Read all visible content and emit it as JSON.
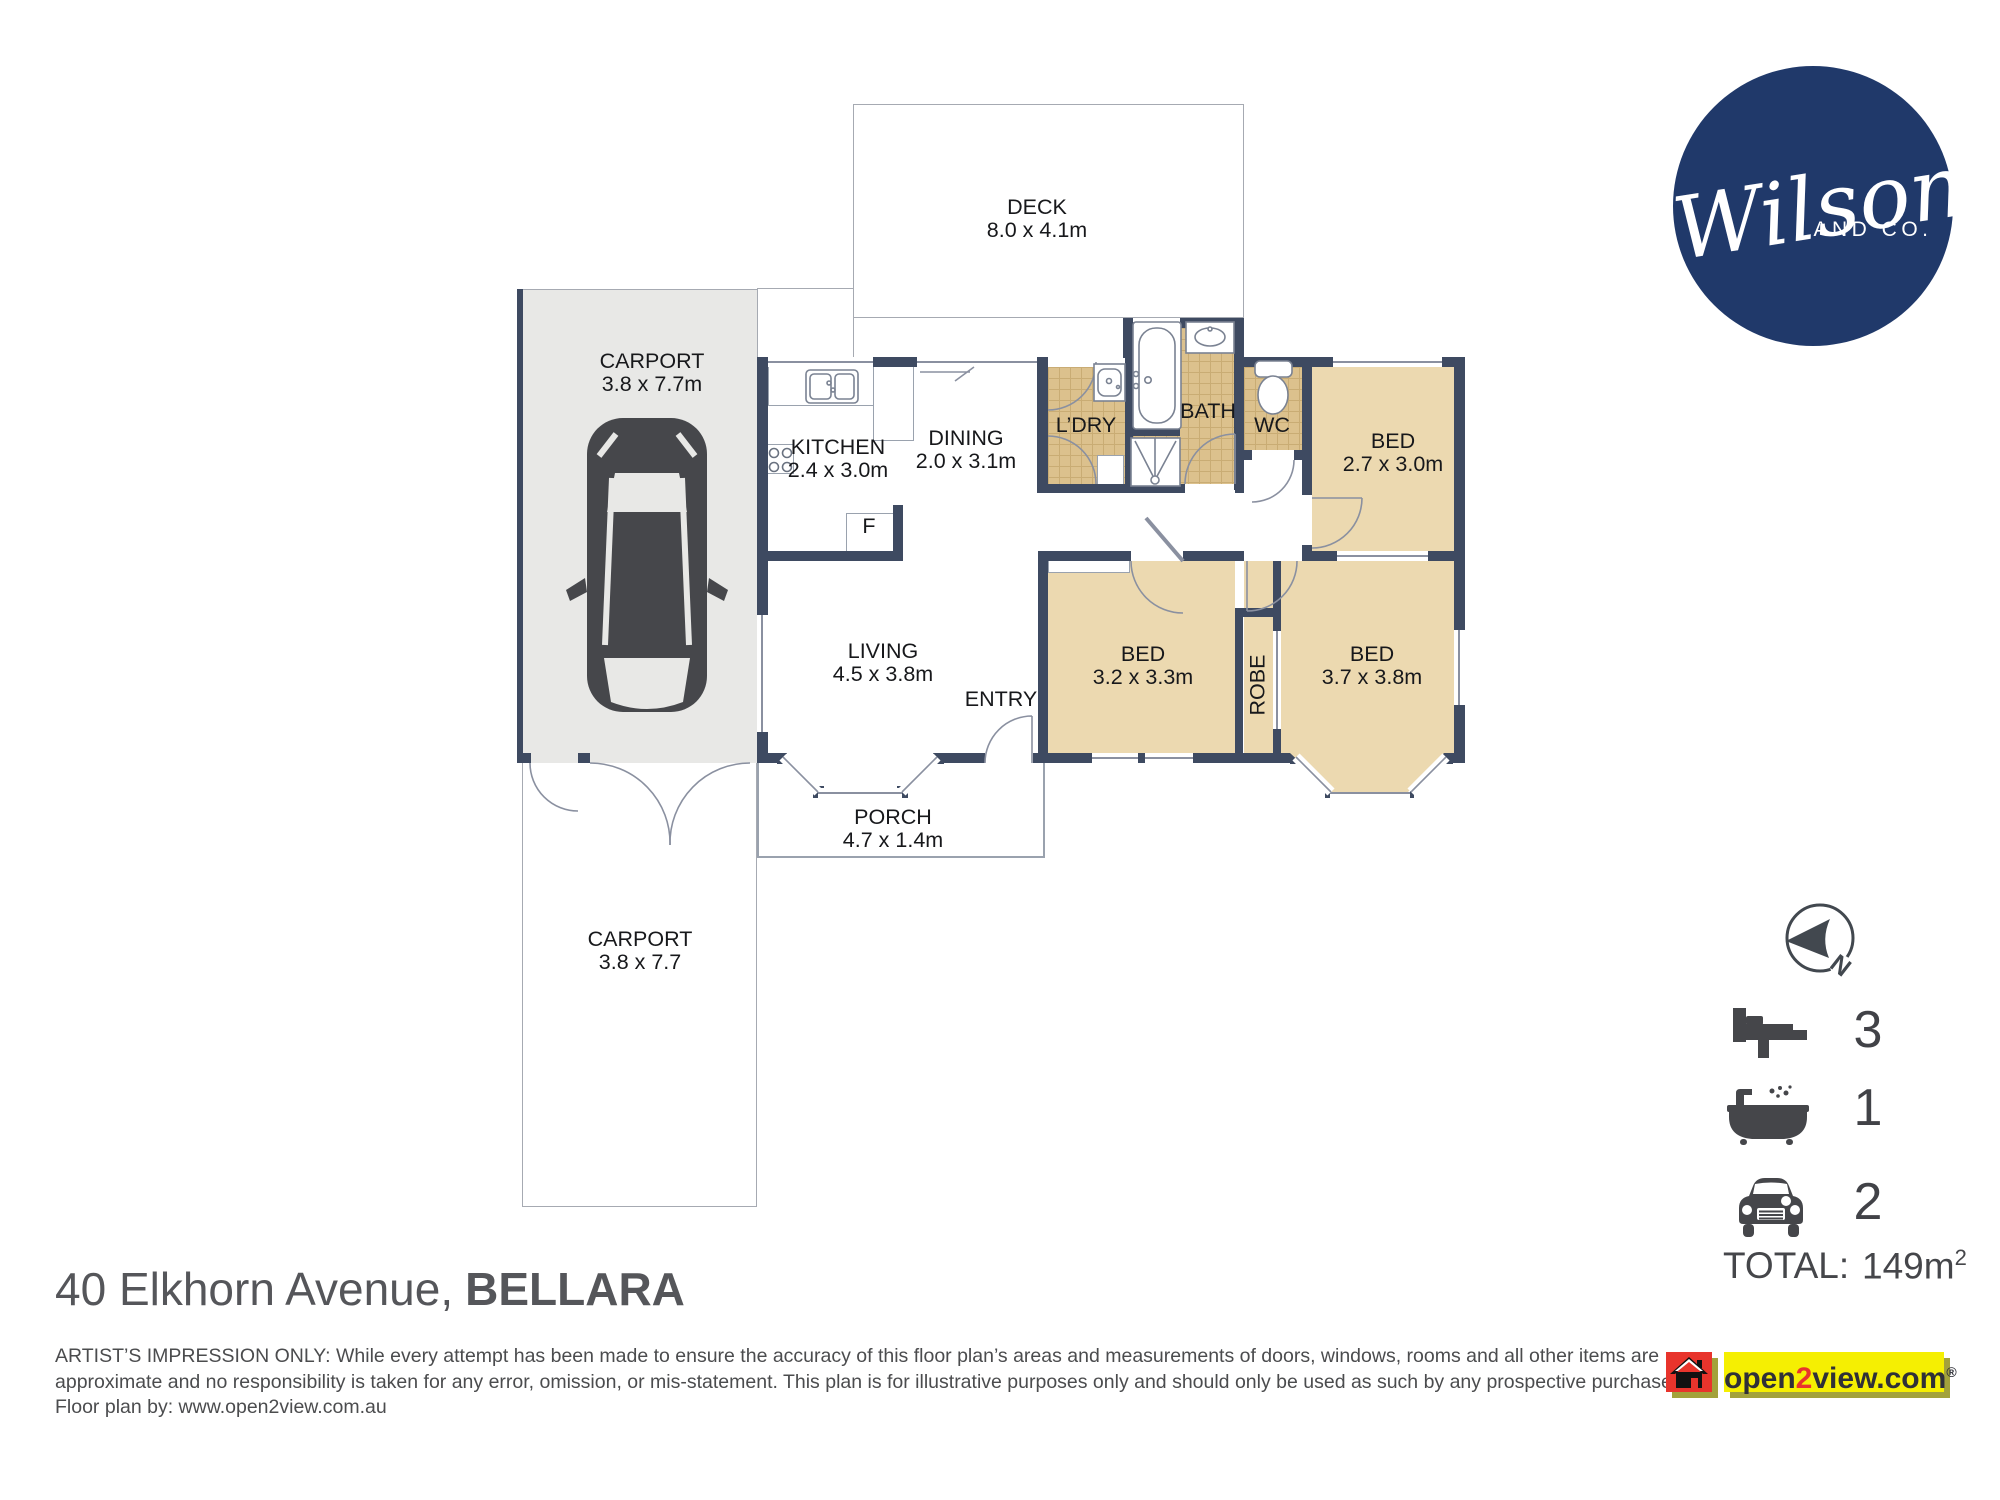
{
  "plan": {
    "deck": {
      "name": "DECK",
      "dims": "8.0 x 4.1m"
    },
    "carport_top": {
      "name": "CARPORT",
      "dims": "3.8 x 7.7m"
    },
    "kitchen": {
      "name": "KITCHEN",
      "dims": "2.4 x 3.0m"
    },
    "dining": {
      "name": "DINING",
      "dims": "2.0 x 3.1m"
    },
    "laundry": {
      "name": "L’DRY"
    },
    "bath": {
      "name": "BATH"
    },
    "wc": {
      "name": "WC"
    },
    "bed1": {
      "name": "BED",
      "dims": "2.7 x 3.0m"
    },
    "living": {
      "name": "LIVING",
      "dims": "4.5 x 3.8m"
    },
    "entry": {
      "name": "ENTRY"
    },
    "fridge": {
      "name": "F"
    },
    "bed2": {
      "name": "BED",
      "dims": "3.2 x 3.3m"
    },
    "robe": {
      "name": "ROBE"
    },
    "bed3": {
      "name": "BED",
      "dims": "3.7 x 3.8m"
    },
    "porch": {
      "name": "PORCH",
      "dims": "4.7 x 1.4m"
    },
    "carport_bottom": {
      "name": "CARPORT",
      "dims": "3.8 x 7.7"
    }
  },
  "branding": {
    "logo_script": "Wilson",
    "logo_subtext": "AND CO.",
    "logo_color": "#20396a"
  },
  "compass": {
    "north": "N"
  },
  "summary": {
    "bedrooms": "3",
    "bathrooms": "1",
    "car_spaces": "2",
    "total_label": "TOTAL:",
    "total_value": "149m",
    "total_superscript": "2"
  },
  "address": {
    "street": "40 Elkhorn Avenue,",
    "suburb": "BELLARA"
  },
  "disclaimer": {
    "line1": "ARTIST’S IMPRESSION ONLY: While every attempt has been made to ensure the accuracy of this floor plan’s areas and measurements of doors, windows, rooms and all other items are",
    "line2": "approximate and no responsibility is taken for any error, omission, or mis-statement. This plan is for illustrative purposes only and should only be used as such by any prospective purchaser.",
    "line3": "Floor plan by: www.open2view.com.au"
  },
  "footer_logo": {
    "part_open": "open",
    "part_two": "2",
    "part_view": "view.com",
    "registered": "®"
  },
  "colors": {
    "wall": "#3e4a61",
    "room_tan": "#ecd9b0",
    "tile": "#dcc18d",
    "carport_gray": "#e8e8e6",
    "brand_navy": "#20396a",
    "o2v_yellow": "#f5ef02",
    "o2v_red": "#e8342c"
  }
}
